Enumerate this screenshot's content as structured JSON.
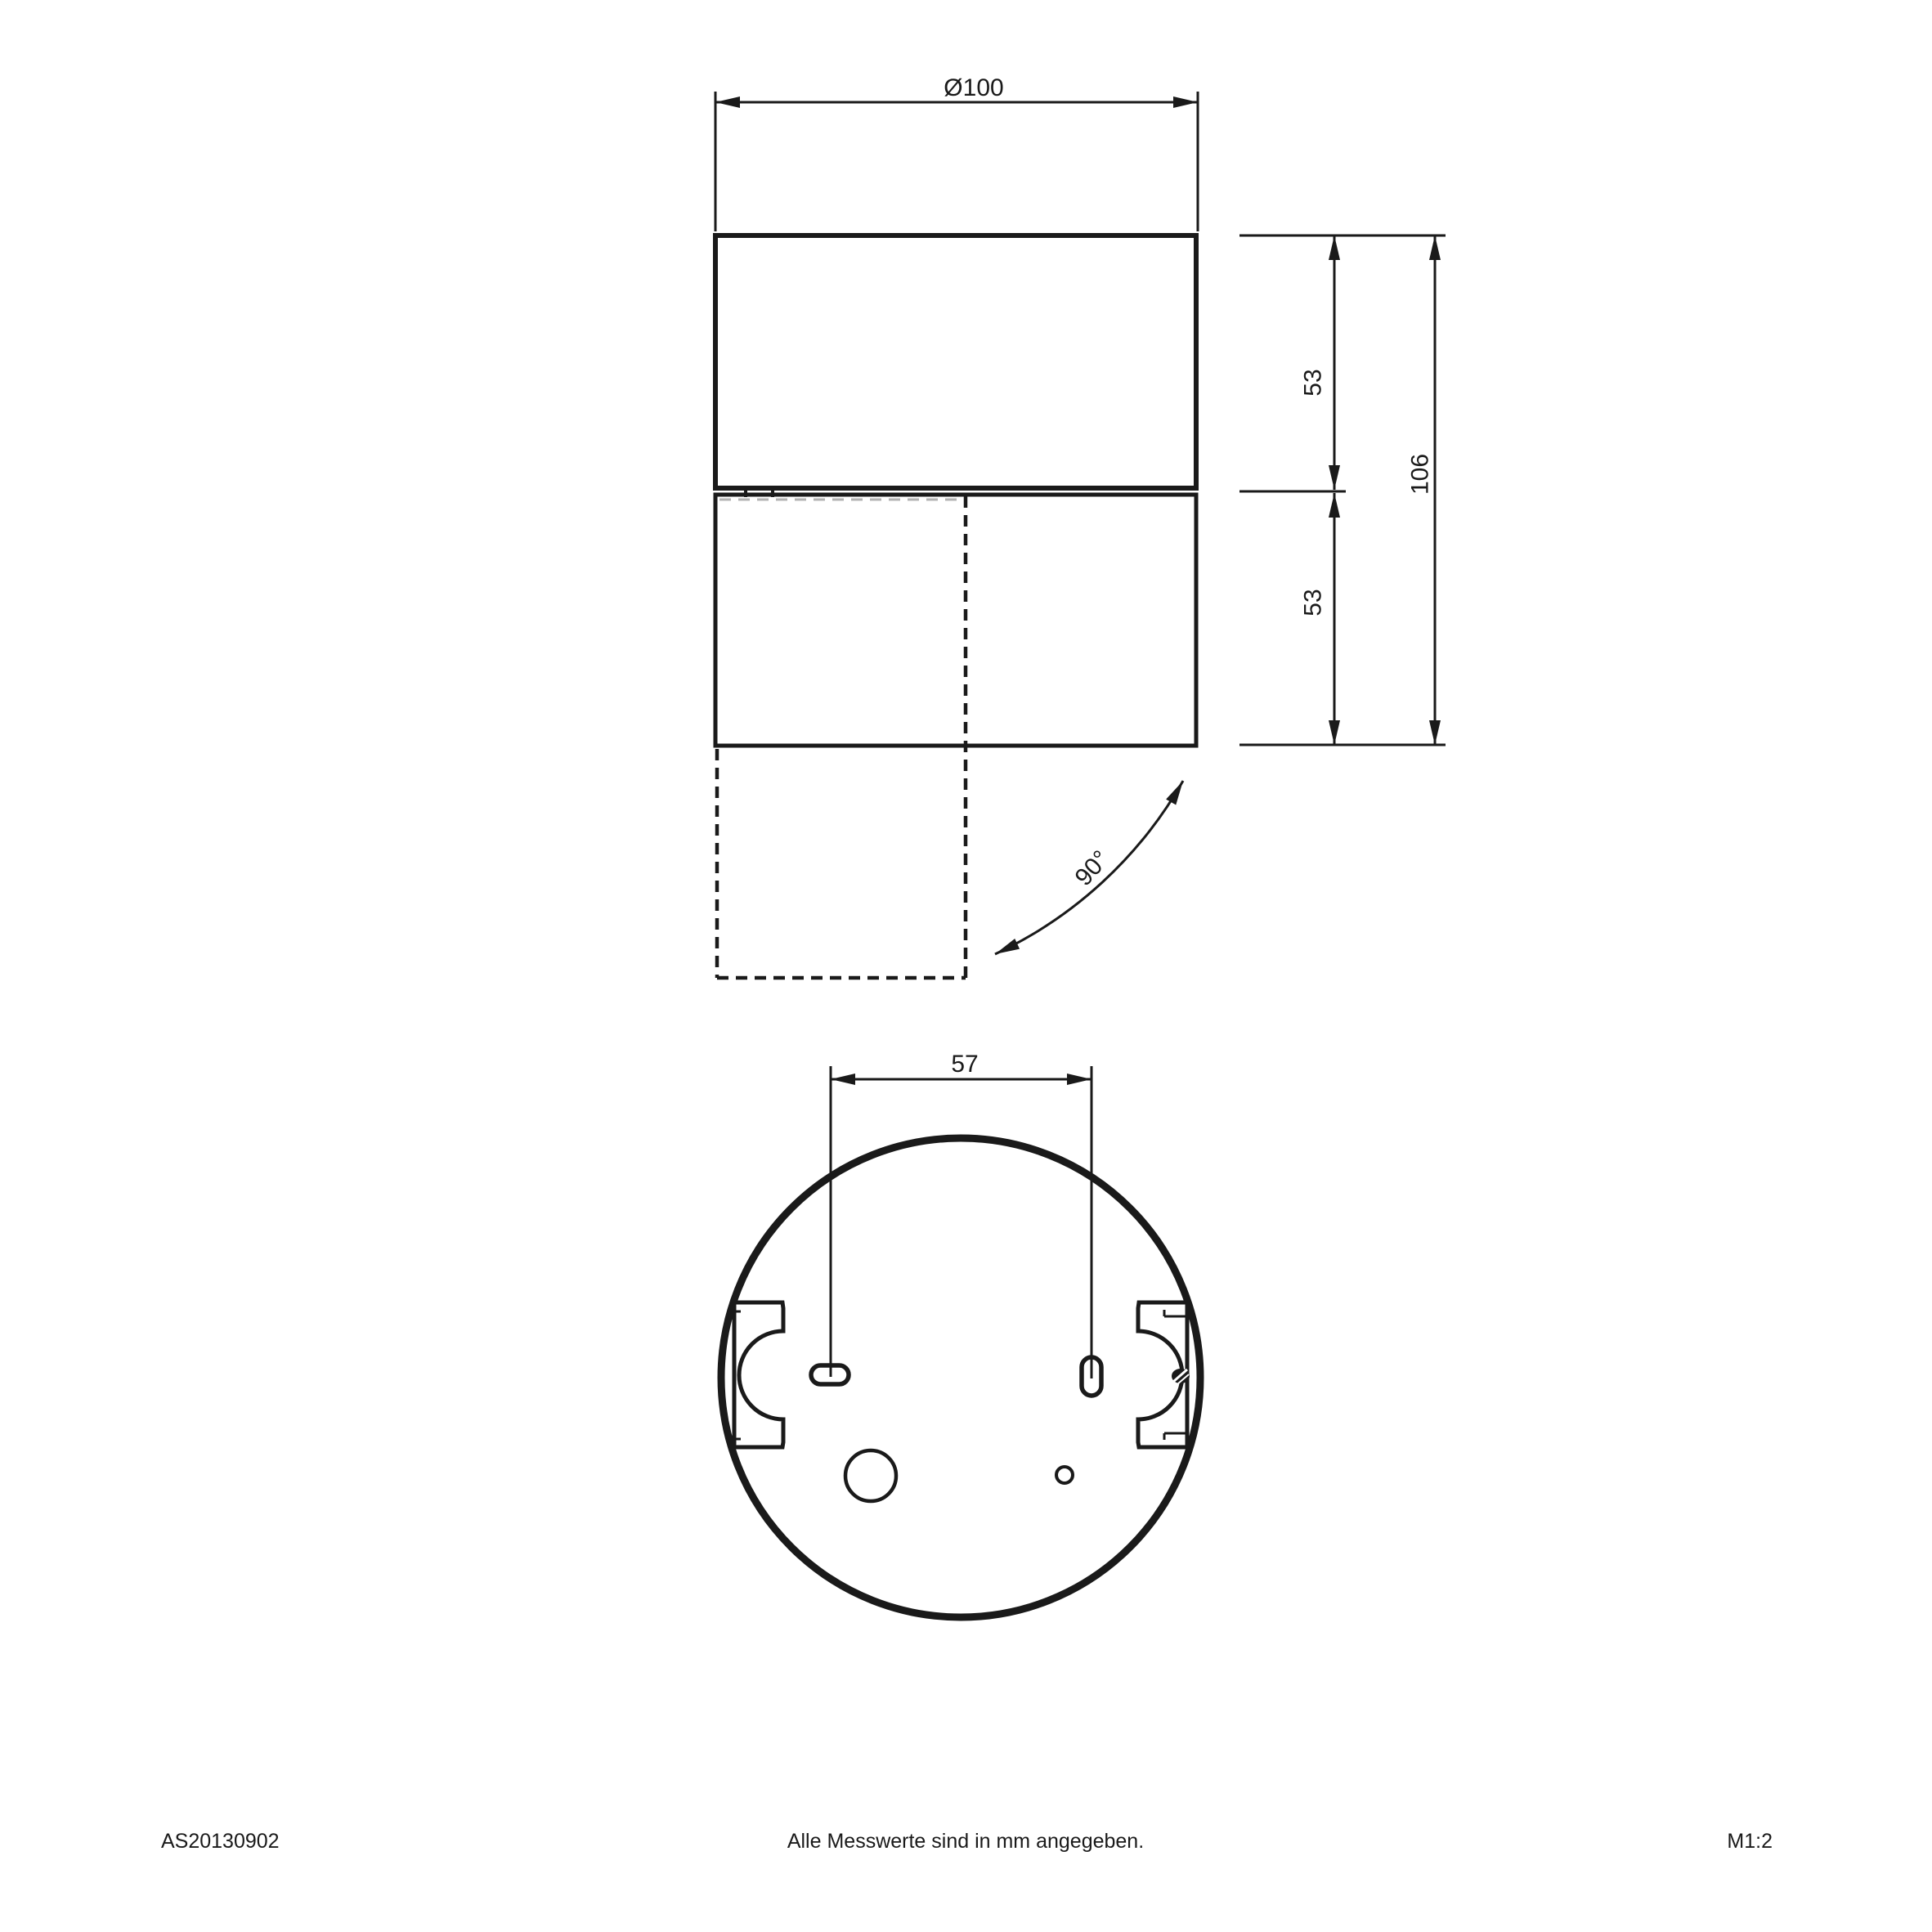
{
  "dimensions": {
    "diameter": "Ø100",
    "upper_height": "53",
    "lower_height": "53",
    "total_height": "106",
    "slot_spacing": "57",
    "tilt_angle": "90°"
  },
  "footer": {
    "article_number": "AS20130902",
    "note": "Alle Messwerte sind in mm angegeben.",
    "scale": "M1:2"
  },
  "colors": {
    "line": "#1a1a1a",
    "background": "#ffffff"
  }
}
